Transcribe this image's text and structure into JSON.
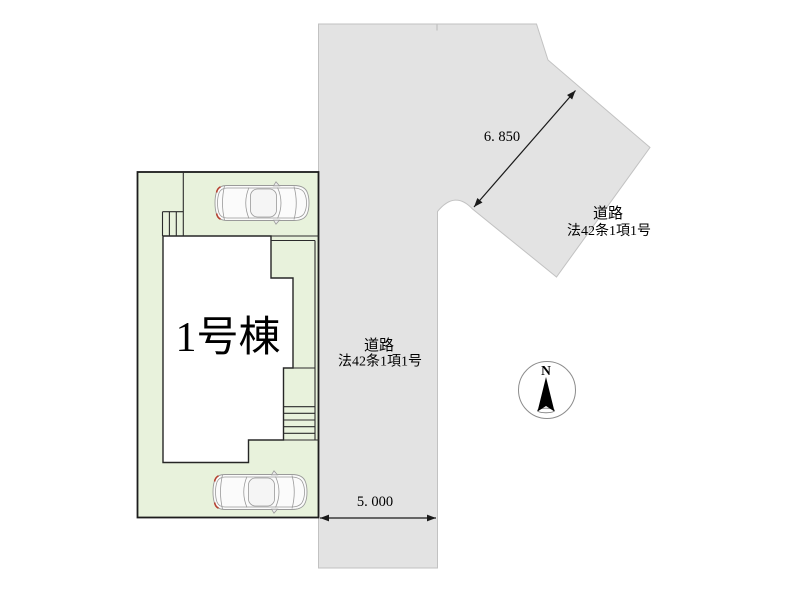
{
  "site_plan": {
    "building": {
      "label": "1号棟"
    },
    "road_vertical": {
      "label_line1": "道路",
      "label_line2": "法42条1項1号",
      "width_dimension": "5. 000"
    },
    "road_diagonal": {
      "label_line1": "道路",
      "label_line2": "法42条1項1号",
      "width_dimension": "6. 850"
    },
    "compass": {
      "north_label": "N"
    },
    "colors": {
      "plot_fill": "#e8f2dc",
      "plot_border": "#1c1c1c",
      "road_fill": "#e3e3e3",
      "road_border": "#c2c2c2",
      "building_fill": "#ffffff",
      "building_border": "#262626",
      "dimension_line": "#1a1a1a",
      "car_body": "#fbfbfb",
      "car_outline": "#9a9a9a",
      "car_tail_accent": "#b5402f",
      "text": "#000000"
    }
  }
}
